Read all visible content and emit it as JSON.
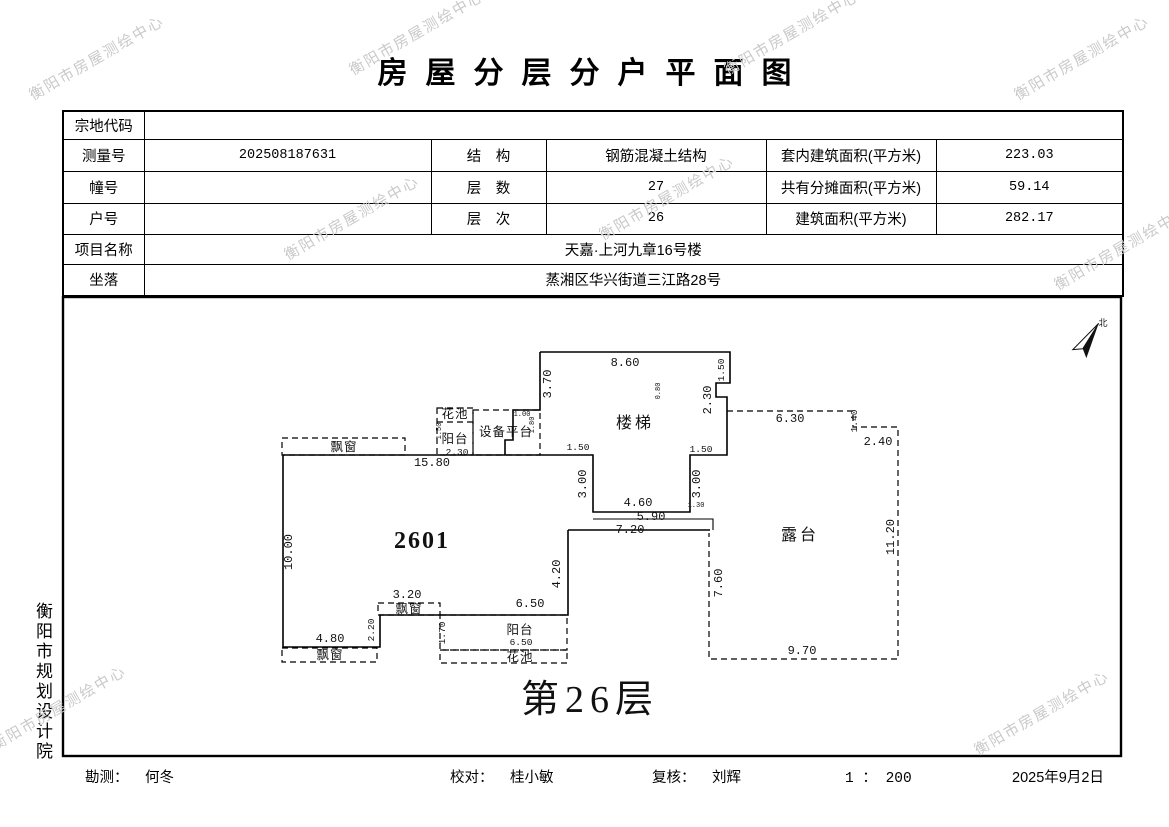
{
  "title": "房屋分层分户平面图",
  "watermark": {
    "text": "衡阳市房屋测绘中心",
    "color": "#c9c9c9"
  },
  "side_label": "衡阳市规划设计院",
  "info_table": {
    "parcel_label": "宗地代码",
    "parcel_value": "",
    "survey_label": "测量号",
    "survey_value": "202508187631",
    "structure_label": "结　构",
    "structure_value": "钢筋混凝土结构",
    "inner_area_label": "套内建筑面积(平方米)",
    "inner_area_value": "223.03",
    "building_label": "幢号",
    "building_value": "",
    "floors_label": "层　数",
    "floors_value": "27",
    "shared_label": "共有分摊面积(平方米)",
    "shared_value": "59.14",
    "unit_label": "户号",
    "unit_value": "",
    "level_label": "层　次",
    "level_value": "26",
    "area_label": "建筑面积(平方米)",
    "area_value": "282.17",
    "project_label": "项目名称",
    "project_value": "天嘉·上河九章16号楼",
    "location_label": "坐落",
    "location_value": "蒸湘区华兴街道三江路28号"
  },
  "plan": {
    "floor_label": "第26层",
    "scale": "1 : 200",
    "annotations": [
      {
        "t": "楼梯",
        "x": 635,
        "y": 428,
        "cls": "room"
      },
      {
        "t": "露台",
        "x": 800,
        "y": 540,
        "cls": "room"
      },
      {
        "t": "2601",
        "x": 422,
        "y": 548,
        "cls": "unit"
      },
      {
        "t": "设备平台",
        "x": 506,
        "y": 436,
        "cls": "room-s"
      },
      {
        "t": "阳台",
        "x": 455,
        "y": 443,
        "cls": "room-s"
      },
      {
        "t": "花池",
        "x": 455,
        "y": 418,
        "cls": "room-s"
      },
      {
        "t": "飘窗",
        "x": 344,
        "y": 451,
        "cls": "room-s"
      },
      {
        "t": "飘窗",
        "x": 409,
        "y": 613,
        "cls": "room-s"
      },
      {
        "t": "飘窗",
        "x": 330,
        "y": 659,
        "cls": "room-s"
      },
      {
        "t": "阳台",
        "x": 520,
        "y": 634,
        "cls": "room-s"
      },
      {
        "t": "花池",
        "x": 520,
        "y": 661,
        "cls": "room-s"
      },
      {
        "t": "第26层",
        "x": 590,
        "y": 712,
        "cls": "floor"
      },
      {
        "t": "北",
        "x": 1103,
        "y": 326,
        "cls": "north"
      },
      {
        "t": "8.60",
        "x": 625,
        "y": 366,
        "cls": "dim"
      },
      {
        "t": "3.70",
        "x": 551,
        "y": 384,
        "rot": -90,
        "cls": "dim"
      },
      {
        "t": "1.50",
        "x": 724,
        "y": 370,
        "rot": -90,
        "cls": "dim-s"
      },
      {
        "t": "2.30",
        "x": 711,
        "y": 400,
        "rot": -90,
        "cls": "dim"
      },
      {
        "t": "0.80",
        "x": 660,
        "y": 391,
        "rot": -90,
        "cls": "dim-t"
      },
      {
        "t": "6.30",
        "x": 790,
        "y": 422,
        "cls": "dim"
      },
      {
        "t": "1.40",
        "x": 857,
        "y": 421,
        "rot": -90,
        "cls": "dim-s"
      },
      {
        "t": "2.40",
        "x": 878,
        "y": 445,
        "cls": "dim"
      },
      {
        "t": "11.20",
        "x": 894,
        "y": 537,
        "rot": -90,
        "cls": "dim"
      },
      {
        "t": "9.70",
        "x": 802,
        "y": 654,
        "cls": "dim"
      },
      {
        "t": "7.60",
        "x": 722,
        "y": 583,
        "rot": -90,
        "cls": "dim"
      },
      {
        "t": "3.00",
        "x": 586,
        "y": 484,
        "rot": -90,
        "cls": "dim"
      },
      {
        "t": "3.00",
        "x": 700,
        "y": 484,
        "rot": -90,
        "cls": "dim"
      },
      {
        "t": "4.60",
        "x": 638,
        "y": 506,
        "cls": "dim"
      },
      {
        "t": "1.30",
        "x": 696,
        "y": 507,
        "cls": "dim-t"
      },
      {
        "t": "5.90",
        "x": 651,
        "y": 520,
        "cls": "dim"
      },
      {
        "t": "7.20",
        "x": 630,
        "y": 533,
        "cls": "dim"
      },
      {
        "t": "1.50",
        "x": 578,
        "y": 450,
        "cls": "dim-s"
      },
      {
        "t": "1.50",
        "x": 701,
        "y": 452,
        "cls": "dim-s"
      },
      {
        "t": "15.80",
        "x": 432,
        "y": 466,
        "cls": "dim"
      },
      {
        "t": "2.30",
        "x": 457,
        "y": 455,
        "cls": "dim-s"
      },
      {
        "t": "1.50",
        "x": 441,
        "y": 431,
        "rot": -90,
        "cls": "dim-t"
      },
      {
        "t": "1.80",
        "x": 534,
        "y": 425,
        "rot": -90,
        "cls": "dim-t"
      },
      {
        "t": "1.00",
        "x": 522,
        "y": 416,
        "cls": "dim-t"
      },
      {
        "t": "10.00",
        "x": 292,
        "y": 552,
        "rot": -90,
        "cls": "dim"
      },
      {
        "t": "4.20",
        "x": 560,
        "y": 574,
        "rot": -90,
        "cls": "dim"
      },
      {
        "t": "6.50",
        "x": 530,
        "y": 607,
        "cls": "dim"
      },
      {
        "t": "3.20",
        "x": 407,
        "y": 598,
        "cls": "dim"
      },
      {
        "t": "2.20",
        "x": 374,
        "y": 630,
        "rot": -90,
        "cls": "dim-s"
      },
      {
        "t": "4.80",
        "x": 330,
        "y": 642,
        "cls": "dim"
      },
      {
        "t": "6.50",
        "x": 521,
        "y": 645,
        "cls": "dim-s"
      },
      {
        "t": "1.70",
        "x": 445,
        "y": 633,
        "rot": -90,
        "cls": "dim-s"
      }
    ]
  },
  "footer": {
    "surveyor_label": "勘测：",
    "surveyor": "何冬",
    "checker_label": "校对：",
    "checker": "桂小敏",
    "reviewer_label": "复核：",
    "reviewer": "刘辉",
    "scale": "1 ： 200",
    "date": "2025年9月2日"
  }
}
